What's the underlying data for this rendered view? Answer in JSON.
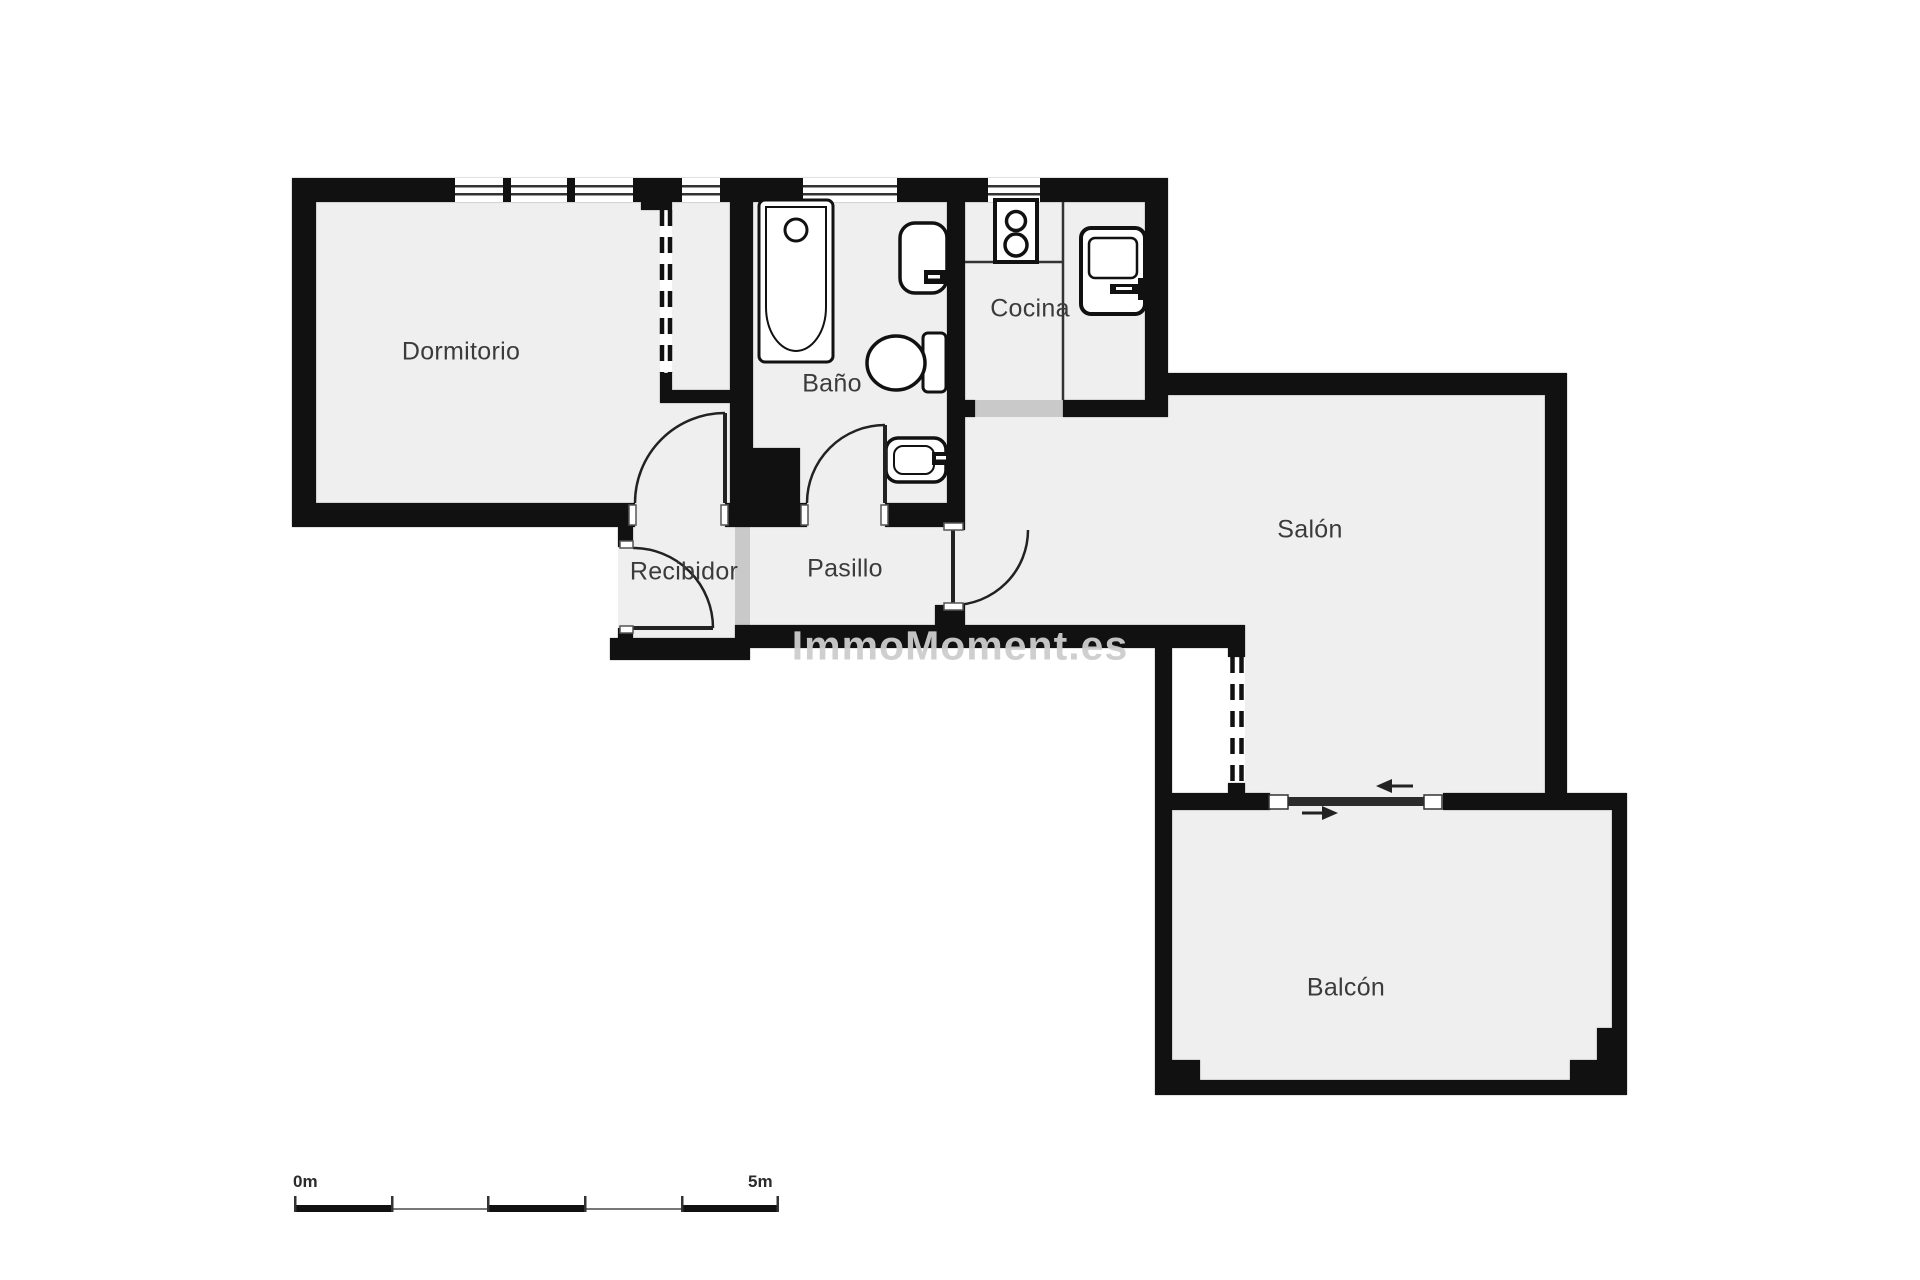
{
  "plan": {
    "rooms": [
      {
        "id": "dormitorio",
        "label": "Dormitorio"
      },
      {
        "id": "bano",
        "label": "Baño"
      },
      {
        "id": "cocina",
        "label": "Cocina"
      },
      {
        "id": "salon",
        "label": "Salón"
      },
      {
        "id": "recibidor",
        "label": "Recibidor"
      },
      {
        "id": "pasillo",
        "label": "Pasillo"
      },
      {
        "id": "balcon",
        "label": "Balcón"
      }
    ],
    "watermark": "ImmoMoment.es",
    "fixtures": [
      "bathtub",
      "bathtub-drain",
      "wall-sink",
      "toilet",
      "vanity-sink",
      "stove-two-burners",
      "kitchen-sink",
      "kitchen-counter"
    ],
    "doors": [
      "dormitorio-swing-door",
      "bano-swing-door",
      "entry-swing-door",
      "salon-swing-door",
      "balcony-sliding-door"
    ],
    "windows_count": 4,
    "colors": {
      "wall": "#111111",
      "floor": "#efefef",
      "threshold": "#c9c9c9",
      "label": "#3b3b3b",
      "watermark": "#cdcdcd",
      "scale": "#222222"
    }
  },
  "scale_bar": {
    "start_label": "0m",
    "end_label": "5m",
    "segments": 5
  }
}
